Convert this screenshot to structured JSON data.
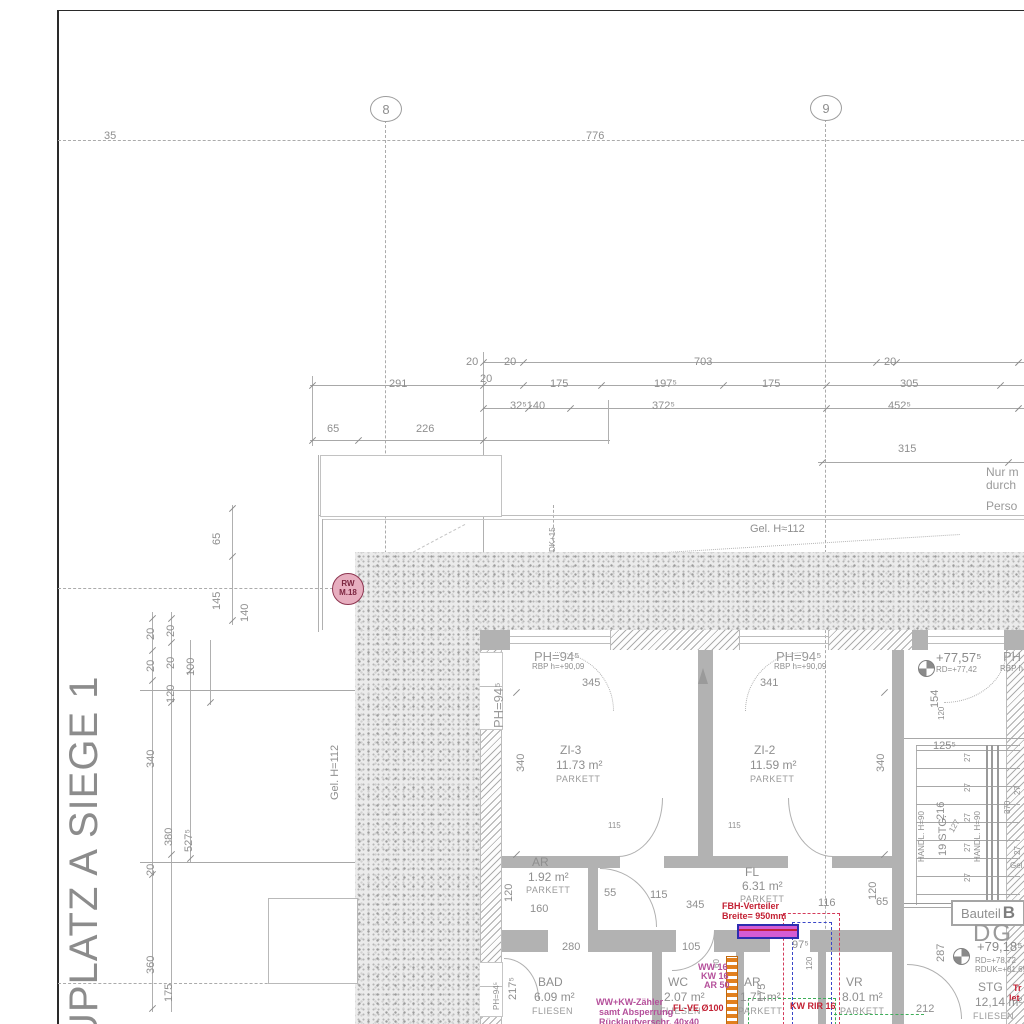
{
  "drawing": {
    "title_vertical": "UPLATZ A  SIEGE 1",
    "grid": {
      "bubbles": [
        {
          "label": "8"
        },
        {
          "label": "9"
        }
      ]
    },
    "rw_symbol": {
      "line1": "RW",
      "line2": "M.18"
    },
    "bauteil": {
      "prefix": "Bauteil",
      "letter": "B"
    }
  },
  "labels": [
    {
      "t": "35",
      "x": 104,
      "y": 131,
      "n": "grid-dim"
    },
    {
      "t": "776",
      "x": 586,
      "y": 131,
      "n": "grid-dim"
    },
    {
      "t": "20",
      "x": 466,
      "y": 357
    },
    {
      "t": "20",
      "x": 504,
      "y": 357
    },
    {
      "t": "703",
      "x": 694,
      "y": 357
    },
    {
      "t": "20",
      "x": 884,
      "y": 357
    },
    {
      "t": "291",
      "x": 389,
      "y": 379
    },
    {
      "t": "20",
      "x": 480,
      "y": 374
    },
    {
      "t": "175",
      "x": 550,
      "y": 379
    },
    {
      "t": "197⁵",
      "x": 654,
      "y": 379
    },
    {
      "t": "175",
      "x": 762,
      "y": 379
    },
    {
      "t": "305",
      "x": 900,
      "y": 379
    },
    {
      "t": "32⁵140",
      "x": 510,
      "y": 401
    },
    {
      "t": "372⁵",
      "x": 652,
      "y": 401
    },
    {
      "t": "452⁵",
      "x": 888,
      "y": 401
    },
    {
      "t": "65",
      "x": 327,
      "y": 424
    },
    {
      "t": "226",
      "x": 416,
      "y": 424
    },
    {
      "t": "315",
      "x": 898,
      "y": 444
    },
    {
      "t": "Gel. H≈112",
      "x": 750,
      "y": 524,
      "n": "terrain-label"
    },
    {
      "t": "Gel. H=112",
      "x": 330,
      "y": 800,
      "r": -90,
      "n": "terrain-label"
    },
    {
      "t": "DK+15",
      "x": 549,
      "y": 552,
      "r": -90,
      "c": "tiny"
    },
    {
      "t": "Nur m",
      "x": 986,
      "y": 466,
      "c": "note",
      "n": "margin-note"
    },
    {
      "t": "durch",
      "x": 986,
      "y": 479,
      "c": "note",
      "n": "margin-note"
    },
    {
      "t": "Perso",
      "x": 986,
      "y": 500,
      "c": "note",
      "n": "margin-note"
    },
    {
      "t": "65",
      "x": 212,
      "y": 545,
      "r": -90
    },
    {
      "t": "145",
      "x": 212,
      "y": 610,
      "r": -90
    },
    {
      "t": "140",
      "x": 240,
      "y": 622,
      "r": -90
    },
    {
      "t": "20",
      "x": 146,
      "y": 640,
      "r": -90
    },
    {
      "t": "20",
      "x": 166,
      "y": 637,
      "r": -90
    },
    {
      "t": "20",
      "x": 146,
      "y": 672,
      "r": -90
    },
    {
      "t": "20",
      "x": 166,
      "y": 669,
      "r": -90
    },
    {
      "t": "100",
      "x": 186,
      "y": 676,
      "r": -90
    },
    {
      "t": "120",
      "x": 166,
      "y": 703,
      "r": -90
    },
    {
      "t": "340",
      "x": 146,
      "y": 768,
      "r": -90
    },
    {
      "t": "380",
      "x": 164,
      "y": 846,
      "r": -90
    },
    {
      "t": "527⁵",
      "x": 184,
      "y": 852,
      "r": -90
    },
    {
      "t": "20",
      "x": 146,
      "y": 876,
      "r": -90
    },
    {
      "t": "360",
      "x": 146,
      "y": 974,
      "r": -90
    },
    {
      "t": "175",
      "x": 164,
      "y": 1002,
      "r": -90
    },
    {
      "t": "PH=94⁵",
      "x": 534,
      "y": 650,
      "c": "win",
      "n": "window-label"
    },
    {
      "t": "RBP h=+90,09",
      "x": 532,
      "y": 663,
      "c": "tiny"
    },
    {
      "t": "PH=94⁵",
      "x": 776,
      "y": 650,
      "c": "win",
      "n": "window-label"
    },
    {
      "t": "RBP h=+90,09",
      "x": 774,
      "y": 663,
      "c": "tiny"
    },
    {
      "t": "PH=94⁵",
      "x": 492,
      "y": 728,
      "r": -90,
      "c": "win",
      "n": "window-label"
    },
    {
      "t": "PH",
      "x": 1003,
      "y": 650,
      "c": "win"
    },
    {
      "t": "RBP h",
      "x": 1000,
      "y": 665,
      "c": "tiny"
    },
    {
      "t": "345",
      "x": 582,
      "y": 678
    },
    {
      "t": "341",
      "x": 760,
      "y": 678
    },
    {
      "t": "340",
      "x": 516,
      "y": 772,
      "r": -90
    },
    {
      "t": "340",
      "x": 876,
      "y": 772,
      "r": -90
    },
    {
      "t": "ZI-3",
      "x": 560,
      "y": 744,
      "c": "room",
      "n": "room-name"
    },
    {
      "t": "11.73 m²",
      "x": 556,
      "y": 759,
      "c": "room",
      "n": "room-area"
    },
    {
      "t": "PARKETT",
      "x": 556,
      "y": 775,
      "c": "mat",
      "n": "room-material"
    },
    {
      "t": "ZI-2",
      "x": 754,
      "y": 744,
      "c": "room",
      "n": "room-name"
    },
    {
      "t": "11.59 m²",
      "x": 750,
      "y": 759,
      "c": "room",
      "n": "room-area"
    },
    {
      "t": "PARKETT",
      "x": 750,
      "y": 775,
      "c": "mat",
      "n": "room-material"
    },
    {
      "t": "115",
      "x": 608,
      "y": 822,
      "c": "tiny"
    },
    {
      "t": "115",
      "x": 728,
      "y": 822,
      "c": "tiny"
    },
    {
      "t": "+77,57⁵",
      "x": 936,
      "y": 651,
      "c": "lvl",
      "n": "level-label"
    },
    {
      "t": "RD=+77,42",
      "x": 936,
      "y": 666,
      "c": "tiny"
    },
    {
      "t": "154",
      "x": 930,
      "y": 708,
      "r": -90
    },
    {
      "t": "120",
      "x": 938,
      "y": 720,
      "r": -90,
      "c": "tiny"
    },
    {
      "t": "125⁵",
      "x": 933,
      "y": 741
    },
    {
      "t": "216",
      "x": 936,
      "y": 820,
      "r": -90,
      "n": "stair-label"
    },
    {
      "t": "19 STG.",
      "x": 938,
      "y": 856,
      "r": -90,
      "n": "stair-label"
    },
    {
      "t": "127",
      "x": 948,
      "y": 830,
      "r": -60,
      "c": "tiny"
    },
    {
      "t": "HANDL. H=90",
      "x": 918,
      "y": 862,
      "r": -90,
      "c": "tiny",
      "n": "handrail-label"
    },
    {
      "t": "HANDL. H=90",
      "x": 974,
      "y": 862,
      "r": -90,
      "c": "tiny",
      "n": "handrail-label"
    },
    {
      "t": "370",
      "x": 1004,
      "y": 814,
      "r": -90,
      "c": "tiny"
    },
    {
      "t": "27",
      "x": 964,
      "y": 762,
      "r": -90,
      "c": "tiny"
    },
    {
      "t": "27",
      "x": 964,
      "y": 792,
      "r": -90,
      "c": "tiny"
    },
    {
      "t": "27",
      "x": 964,
      "y": 822,
      "r": -90,
      "c": "tiny"
    },
    {
      "t": "27",
      "x": 964,
      "y": 852,
      "r": -90,
      "c": "tiny"
    },
    {
      "t": "27",
      "x": 964,
      "y": 882,
      "r": -90,
      "c": "tiny"
    },
    {
      "t": "27",
      "x": 1014,
      "y": 795,
      "r": -90,
      "c": "tiny"
    },
    {
      "t": "27",
      "x": 1014,
      "y": 855,
      "r": -90,
      "c": "tiny"
    },
    {
      "t": "Gel",
      "x": 1010,
      "y": 862,
      "c": "tiny"
    },
    {
      "t": "AR",
      "x": 532,
      "y": 856,
      "c": "room",
      "n": "room-name"
    },
    {
      "t": "1.92 m²",
      "x": 528,
      "y": 871,
      "c": "room",
      "n": "room-area"
    },
    {
      "t": "PARKETT",
      "x": 526,
      "y": 886,
      "c": "mat"
    },
    {
      "t": "160",
      "x": 530,
      "y": 904
    },
    {
      "t": "120",
      "x": 504,
      "y": 902,
      "r": -90
    },
    {
      "t": "FL",
      "x": 745,
      "y": 866,
      "c": "room",
      "n": "room-name"
    },
    {
      "t": "6.31 m²",
      "x": 742,
      "y": 880,
      "c": "room",
      "n": "room-area"
    },
    {
      "t": "PARKETT",
      "x": 740,
      "y": 895,
      "c": "mat"
    },
    {
      "t": "55",
      "x": 604,
      "y": 888
    },
    {
      "t": "115",
      "x": 650,
      "y": 890
    },
    {
      "t": "345",
      "x": 686,
      "y": 900
    },
    {
      "t": "116",
      "x": 818,
      "y": 898
    },
    {
      "t": "65",
      "x": 876,
      "y": 897
    },
    {
      "t": "120",
      "x": 868,
      "y": 900,
      "r": -90
    },
    {
      "t": "FBH-Verteiler",
      "x": 722,
      "y": 902,
      "c": "red",
      "n": "fbh-label"
    },
    {
      "t": "Breite= 950mm",
      "x": 722,
      "y": 912,
      "c": "red",
      "n": "fbh-label"
    },
    {
      "t": "280",
      "x": 562,
      "y": 942
    },
    {
      "t": "105",
      "x": 682,
      "y": 942
    },
    {
      "t": "97⁵",
      "x": 792,
      "y": 940
    },
    {
      "t": "60",
      "x": 713,
      "y": 968,
      "r": -90,
      "c": "tiny"
    },
    {
      "t": "175",
      "x": 757,
      "y": 1002,
      "r": -90
    },
    {
      "t": "120",
      "x": 806,
      "y": 970,
      "r": -90,
      "c": "tiny"
    },
    {
      "t": "BAD",
      "x": 538,
      "y": 976,
      "c": "room",
      "n": "room-name"
    },
    {
      "t": "6.09 m²",
      "x": 534,
      "y": 991,
      "c": "room",
      "n": "room-area"
    },
    {
      "t": "FLIESEN",
      "x": 532,
      "y": 1007,
      "c": "mat"
    },
    {
      "t": "WC",
      "x": 668,
      "y": 976,
      "c": "room",
      "n": "room-name"
    },
    {
      "t": "2.07 m²",
      "x": 664,
      "y": 991,
      "c": "room",
      "n": "room-area"
    },
    {
      "t": "FLIESEN",
      "x": 660,
      "y": 1007,
      "c": "mat"
    },
    {
      "t": "AR",
      "x": 744,
      "y": 976,
      "c": "room",
      "n": "room-name"
    },
    {
      "t": "1.71 m²",
      "x": 740,
      "y": 991,
      "c": "room",
      "n": "room-area"
    },
    {
      "t": "PARKETT",
      "x": 738,
      "y": 1007,
      "c": "mat"
    },
    {
      "t": "VR",
      "x": 846,
      "y": 976,
      "c": "room",
      "n": "room-name"
    },
    {
      "t": "8.01 m²",
      "x": 842,
      "y": 991,
      "c": "room",
      "n": "room-area"
    },
    {
      "t": "PARKETT",
      "x": 840,
      "y": 1007,
      "c": "mat"
    },
    {
      "t": "217⁵",
      "x": 508,
      "y": 1000,
      "r": -90
    },
    {
      "t": "PH=94⁵",
      "x": 493,
      "y": 1010,
      "r": -90,
      "c": "tiny"
    },
    {
      "t": "WW 16",
      "x": 698,
      "y": 963,
      "c": "mag",
      "n": "pipe-label"
    },
    {
      "t": "KW 16",
      "x": 701,
      "y": 972,
      "c": "mag",
      "n": "pipe-label"
    },
    {
      "t": "AR 50",
      "x": 704,
      "y": 981,
      "c": "mag",
      "n": "pipe-label"
    },
    {
      "t": "WW+KW-Zähler",
      "x": 596,
      "y": 998,
      "c": "mag",
      "n": "pipe-label"
    },
    {
      "t": "samt Absperrung",
      "x": 599,
      "y": 1008,
      "c": "mag",
      "n": "pipe-label"
    },
    {
      "t": "Rücklaufverschr. 40x40",
      "x": 599,
      "y": 1018,
      "c": "mag",
      "n": "pipe-label"
    },
    {
      "t": "FL-VE Ø100",
      "x": 673,
      "y": 1004,
      "c": "red",
      "n": "pipe-label"
    },
    {
      "t": "KW RIR 16",
      "x": 790,
      "y": 1002,
      "c": "red",
      "n": "pipe-label"
    },
    {
      "t": "Tr",
      "x": 1013,
      "y": 984,
      "c": "red"
    },
    {
      "t": "let",
      "x": 1009,
      "y": 994,
      "c": "red"
    },
    {
      "t": "DG",
      "x": 973,
      "y": 922,
      "c": "dg",
      "n": "storey-label"
    },
    {
      "t": "+79,18⁵",
      "x": 977,
      "y": 940,
      "c": "lvl",
      "n": "level-label"
    },
    {
      "t": "RD=+78,72",
      "x": 975,
      "y": 957,
      "c": "tiny"
    },
    {
      "t": "RDUK=+81,69",
      "x": 975,
      "y": 966,
      "c": "tiny"
    },
    {
      "t": "287",
      "x": 936,
      "y": 962,
      "r": -90
    },
    {
      "t": "212",
      "x": 916,
      "y": 1004
    },
    {
      "t": "STG",
      "x": 978,
      "y": 981,
      "c": "room",
      "n": "room-name"
    },
    {
      "t": "12,14 m²",
      "x": 975,
      "y": 996,
      "c": "room",
      "n": "room-area"
    },
    {
      "t": "FLIESEN",
      "x": 973,
      "y": 1012,
      "c": "mat"
    }
  ]
}
